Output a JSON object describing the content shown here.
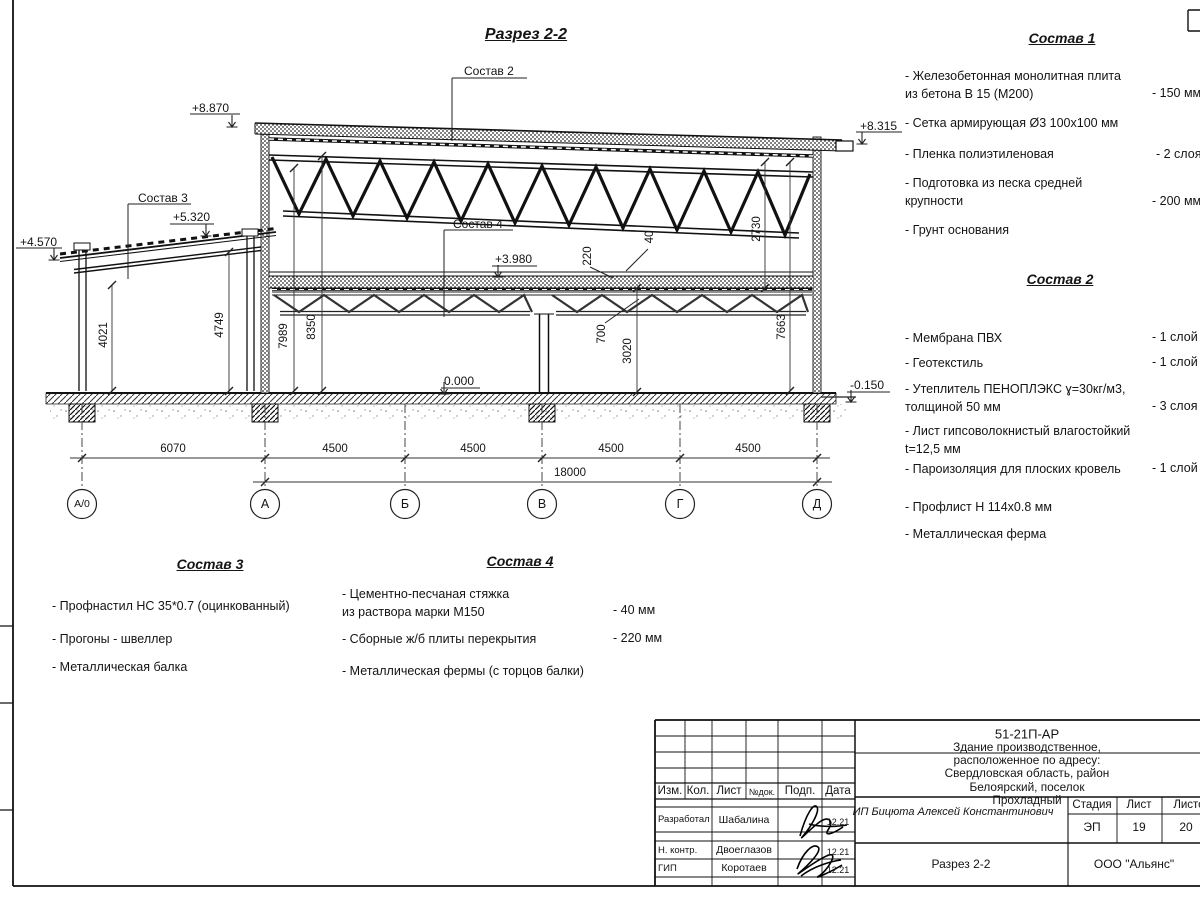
{
  "drawing": {
    "title": "Разрез 2-2",
    "callouts": {
      "c2": "Состав 2",
      "c3": "Состав 3",
      "c4": "Состав 4"
    },
    "elevations": {
      "top_left": "+8.870",
      "top_right": "+8.315",
      "leanto_high": "+5.320",
      "leanto_low": "+4.570",
      "mid_floor": "+3.980",
      "zero": "0.000",
      "minus": "-0.150"
    },
    "vertical_dims": {
      "leanto_left": "4021",
      "leanto_right": "4749",
      "wall_a_inner": "7989",
      "wall_a_outer": "8350",
      "screed": "220",
      "slab": "40",
      "truss_depth": "700",
      "clear_height": "3020",
      "top_clear": "2730",
      "right_total": "7663"
    },
    "horizontal_dims": {
      "bay0": "6070",
      "bay1": "4500",
      "bay2": "4500",
      "bay3": "4500",
      "bay4": "4500",
      "total": "18000"
    },
    "axes": {
      "a0": "А/0",
      "a": "А",
      "b": "Б",
      "v": "В",
      "g": "Г",
      "d": "Д"
    }
  },
  "sostav1": {
    "title": "Состав 1",
    "items": [
      {
        "text": "- Железобетонная  монолитная плита\nиз бетона В 15 (М200)",
        "value": "- 150 мм"
      },
      {
        "text": "- Сетка армирующая Ø3 100х100 мм"
      },
      {
        "text": "- Пленка полиэтиленовая",
        "value": "- 2 слоя"
      },
      {
        "text": "- Подготовка из песка средней\nкрупности",
        "value": "- 200 мм"
      },
      {
        "text": "- Грунт основания"
      }
    ]
  },
  "sostav2": {
    "title": "Состав 2",
    "items": [
      {
        "text": "- Мембрана ПВХ",
        "value": "- 1 слой"
      },
      {
        "text": "- Геотекстиль",
        "value": "- 1 слой"
      },
      {
        "text": "- Утеплитель ПЕНОПЛЭКС ɣ=30кг/м3,\nтолщиной 50 мм",
        "value": "- 3 слоя"
      },
      {
        "text": "- Лист гипсоволокнистый влагостойкий\nt=12,5 мм"
      },
      {
        "text": "- Пароизоляция для плоских кровель",
        "value": "- 1 слой"
      },
      {
        "text": "- Профлист Н 114х0.8 мм"
      },
      {
        "text": "- Металлическая ферма"
      }
    ]
  },
  "sostav3": {
    "title": "Состав 3",
    "items": [
      {
        "text": "- Профнастил НС 35*0.7 (оцинкованный)"
      },
      {
        "text": "- Прогоны - швеллер"
      },
      {
        "text": "- Металлическая балка"
      }
    ]
  },
  "sostav4": {
    "title": "Состав 4",
    "items": [
      {
        "text": "- Цементно-песчаная стяжка\nиз раствора марки М150",
        "value": "- 40 мм"
      },
      {
        "text": "- Сборные ж/б плиты перекрытия",
        "value": "- 220 мм"
      },
      {
        "text": "- Металлическая фермы (с торцов балки)"
      }
    ]
  },
  "titleblock": {
    "doc_code": "51-21П-АР",
    "object": "Здание производственное, расположенное по адресу:\nСвердловская область, район Белоярский, поселок\nПрохладный",
    "columns": {
      "izm": "Изм.",
      "kol": "Кол.",
      "list": "Лист",
      "ndok": "№док.",
      "podp": "Подп.",
      "data": "Дата"
    },
    "rows": [
      {
        "role": "Разработал",
        "name": "Шабалина",
        "date": "12.21"
      },
      {
        "role": "Н. контр.",
        "name": "Двоеглазов",
        "date": "12.21"
      },
      {
        "role": "ГИП",
        "name": "Коротаев",
        "date": "12.21"
      }
    ],
    "designer": "ИП Бицюта Алексей Константинович",
    "stage_label": "Стадия",
    "sheet_label": "Лист",
    "sheets_label": "Листов",
    "stage": "ЭП",
    "sheet_no": "19",
    "sheets_total": "20",
    "drawing_name": "Разрез 2-2",
    "org": "ООО \"Альянс\""
  }
}
